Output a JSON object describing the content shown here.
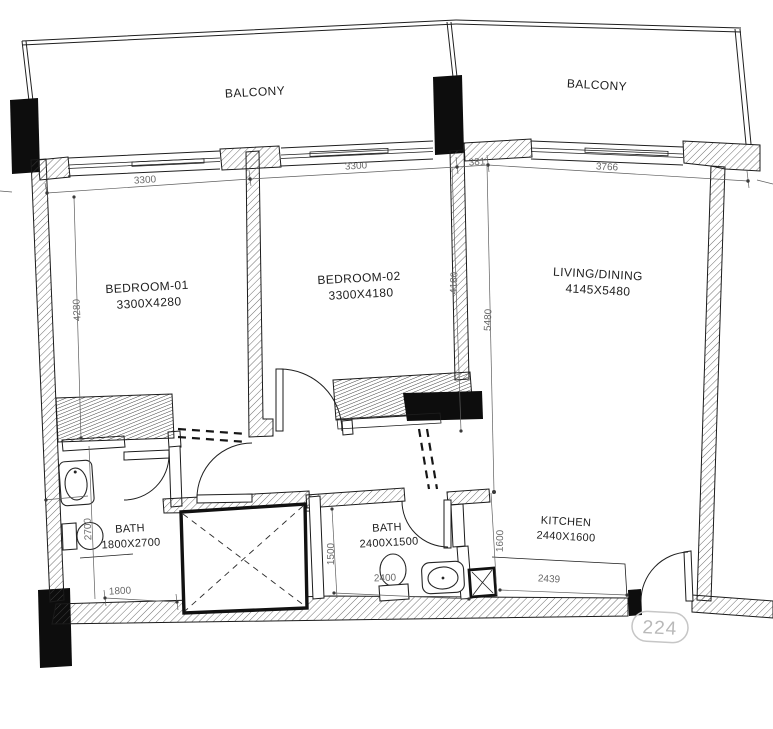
{
  "plan": {
    "unit_number": "224",
    "rooms": {
      "balcony_left": {
        "label": "BALCONY"
      },
      "balcony_right": {
        "label": "BALCONY"
      },
      "bedroom1": {
        "label": "BEDROOM-01",
        "size": "3300X4280"
      },
      "bedroom2": {
        "label": "BEDROOM-02",
        "size": "3300X4180"
      },
      "living": {
        "label": "LIVING/DINING",
        "size": "4145X5480"
      },
      "bath1": {
        "label": "BATH",
        "size": "1800X2700"
      },
      "bath2": {
        "label": "BATH",
        "size": "2400X1500"
      },
      "kitchen": {
        "label": "KITCHEN",
        "size": "2440X1600"
      }
    },
    "dimensions": {
      "bed1_width": "3300",
      "bed2_width": "3300",
      "living_offset": "381",
      "living_width": "3766",
      "bed1_depth": "4280",
      "bed2_depth": "4180",
      "living_depth": "5480",
      "bath1_depth": "2700",
      "bath1_width": "1800",
      "bath2_depth": "1500",
      "bath2_width": "2400",
      "kitchen_depth": "1600",
      "kitchen_width": "2439"
    },
    "colors": {
      "ink": "#1b1b1b",
      "dim_text": "#6a6a6a",
      "unit_badge": "#b9b9b9"
    }
  }
}
